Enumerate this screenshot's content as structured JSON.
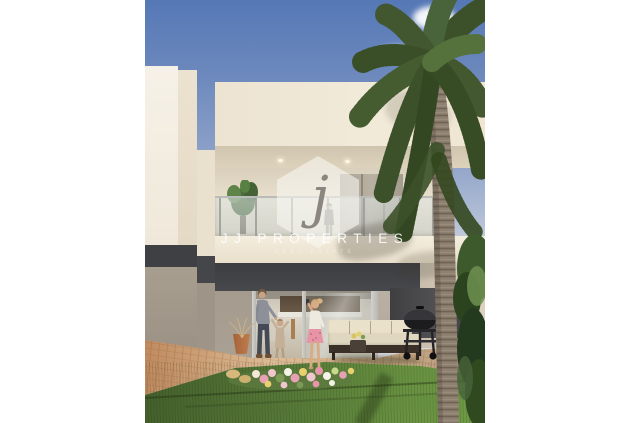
{
  "watermark": {
    "logo_letter": "j",
    "brand_name": "JJ PROPERTIES",
    "tagline": "REAL ESTATE"
  },
  "palette": {
    "letterbox_white": "#ffffff",
    "sky_top": "#5578b6",
    "sky_horizon": "#d8d8da",
    "facade_cream": "#efe6d4",
    "facade_bright": "#f6f1e8",
    "accent_band_anthracite": "#3e4043",
    "ground_wall_taupe": "#a59c8f",
    "glass_tint": "#aeb6b2",
    "paver_terracotta": "#c89a72",
    "grass_green": "#577a38",
    "palm_frond_green": "#44582f",
    "palm_trunk_gray": "#8f8171",
    "watermark_white": "#ffffff",
    "watermark_letter_gray": "#8b8680"
  },
  "scene": {
    "description": "Architect render of a two-storey white townhouse rear facade with balcony, open sliding glass doors, outdoor lounge, BBQ, lawn with flower arrangement, tall palm tree, family of four",
    "objects": [
      "sky-with-clouds",
      "neighbour-white-wall",
      "main-facade-upper-floor",
      "balcony-glass-railing",
      "balcony-plant",
      "woman-on-balcony",
      "anthracite-floor-band",
      "sliding-glass-doors",
      "interior-kitchen",
      "man-with-toddler",
      "girl-taking-photo",
      "outdoor-sofa",
      "bbq-grill",
      "terracotta-pot",
      "paved-patio",
      "lawn",
      "flower-arrangement",
      "palm-tree",
      "hedge-greenery"
    ]
  }
}
